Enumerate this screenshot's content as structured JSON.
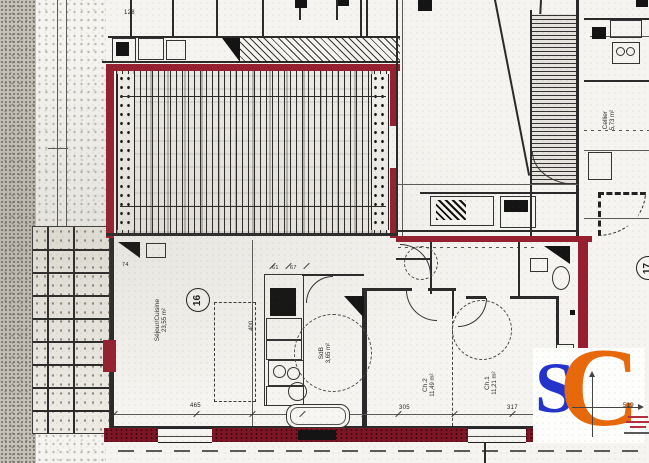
{
  "plan": {
    "unit_badge": "16",
    "adjacent_badge": "17",
    "rooms": {
      "sejour": {
        "name": "Séjour/Cuisine",
        "area": "23,55 m²"
      },
      "sdb": {
        "name": "SdB",
        "area": "3,65 m²"
      },
      "ch2": {
        "name": "Ch.2",
        "area": "11,49 m²"
      },
      "ch1": {
        "name": "Ch.1",
        "area": "11,21 m²"
      },
      "cellier": {
        "name": "Cellier",
        "area": "5,73 m²"
      }
    },
    "dims": {
      "d128": "128",
      "d74": "74",
      "d61": "61",
      "d67": "67",
      "d400": "400",
      "d465": "465",
      "d305": "305",
      "d317": "317",
      "d519": "519"
    },
    "colors": {
      "boundary_red": "#96202f",
      "boundary_red_dark": "#7e1525",
      "ink": "#222222",
      "paper": "#f5f4f0"
    }
  },
  "logo": {
    "letter_s": "S",
    "letter_c": "C",
    "s_color": "#2433cc",
    "c_color": "#e8690b"
  }
}
